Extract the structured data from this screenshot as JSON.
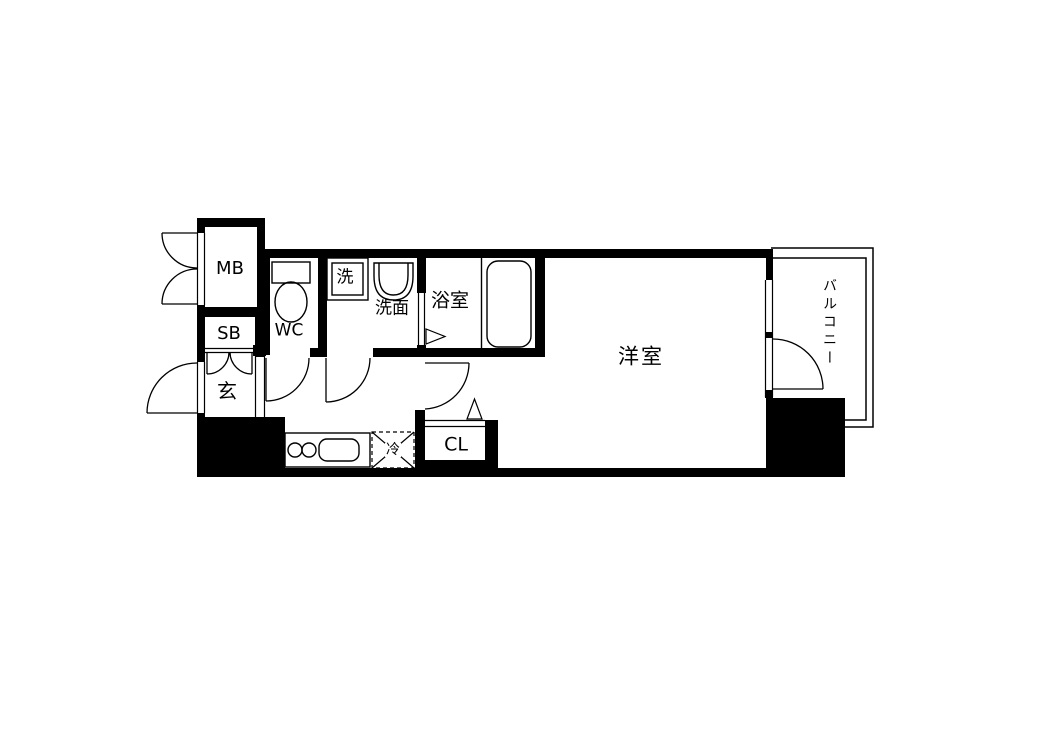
{
  "colors": {
    "background": "#ffffff",
    "line": "#000000"
  },
  "rooms": {
    "meter_box": {
      "label": "MB"
    },
    "shoe_box": {
      "label": "SB"
    },
    "entrance": {
      "label": "玄"
    },
    "toilet": {
      "label": "WC"
    },
    "washer": {
      "label": "洗"
    },
    "washroom": {
      "label": "洗面"
    },
    "bathroom": {
      "label": "浴室"
    },
    "western_room": {
      "label": "洋室"
    },
    "closet": {
      "label": "CL"
    },
    "refrigerator": {
      "label": "冷"
    },
    "balcony": {
      "label": "バルコニー"
    }
  }
}
